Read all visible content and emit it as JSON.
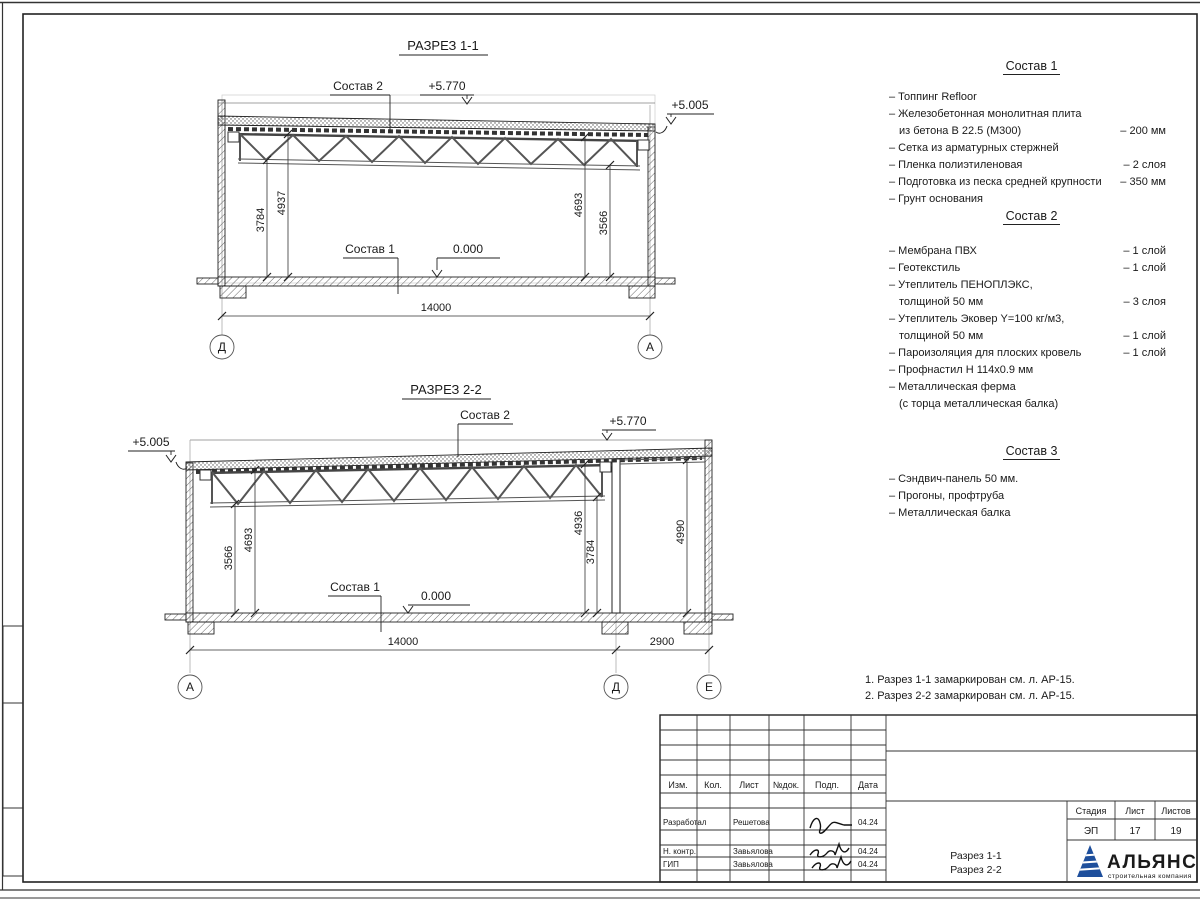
{
  "drawing": {
    "section1": {
      "title": "РАЗРЕЗ 1-1",
      "labels": {
        "sostav2": "Состав 2",
        "sostav1": "Состав 1",
        "elev_high": "+5.770",
        "elev_low": "+5.005",
        "elev_zero": "0.000"
      },
      "dims": {
        "d1": "3784",
        "d2": "4937",
        "d3": "4693",
        "d4": "3566",
        "span": "14000"
      },
      "axis_left": "Д",
      "axis_right": "А"
    },
    "section2": {
      "title": "РАЗРЕЗ 2-2",
      "labels": {
        "sostav2": "Состав 2",
        "sostav1": "Состав 1",
        "elev_high": "+5.770",
        "elev_low": "+5.005",
        "elev_zero": "0.000"
      },
      "dims": {
        "d1": "3566",
        "d2": "4693",
        "d3": "4936",
        "d4": "3784",
        "d5": "4990",
        "span": "14000",
        "span2": "2900"
      },
      "axis_left": "А",
      "axis_mid": "Д",
      "axis_right": "Е"
    }
  },
  "compositions": [
    {
      "title": "Состав 1",
      "items": [
        {
          "t": "– Топпинг Refloor"
        },
        {
          "t": "– Железобетонная  монолитная плита"
        },
        {
          "t": "из бетона В 22.5 (М300)",
          "v": "– 200 мм"
        },
        {
          "t": "– Сетка из арматурных стержней"
        },
        {
          "t": "– Пленка полиэтиленовая",
          "v": "– 2 слоя"
        },
        {
          "t": "– Подготовка из песка средней крупности",
          "v": "– 350 мм"
        },
        {
          "t": "– Грунт основания"
        }
      ]
    },
    {
      "title": "Состав 2",
      "items": [
        {
          "t": "– Мембрана ПВХ",
          "v": "– 1 слой"
        },
        {
          "t": "– Геотекстиль",
          "v": "– 1 слой"
        },
        {
          "t": "– Утеплитель ПЕНОПЛЭКС,"
        },
        {
          "t": "толщиной 50 мм",
          "v": "– 3 слоя"
        },
        {
          "t": "– Утеплитель Эковер Y=100 кг/м3,"
        },
        {
          "t": "толщиной 50 мм",
          "v": "– 1 слой"
        },
        {
          "t": "– Пароизоляция для плоских кровель",
          "v": "– 1 слой"
        },
        {
          "t": "– Профнастил Н 114х0.9 мм"
        },
        {
          "t": "– Металлическая ферма"
        },
        {
          "t": "(с торца металлическая балка)"
        }
      ]
    },
    {
      "title": "Состав 3",
      "items": [
        {
          "t": "– Сэндвич-панель 50 мм."
        },
        {
          "t": "– Прогоны, профтруба"
        },
        {
          "t": "– Металлическая балка"
        }
      ]
    }
  ],
  "notes": [
    "1. Разрез 1-1 замаркирован см. л. АР-15.",
    "2. Разрез 2-2 замаркирован см. л. АР-15."
  ],
  "titleblock": {
    "headers": [
      "Изм.",
      "Кол.",
      "Лист",
      "№док.",
      "Подп.",
      "Дата"
    ],
    "rows": [
      {
        "role": "Разработал",
        "name": "Решетова",
        "date": "04.24"
      },
      {
        "role": "Н. контр.",
        "name": "Завьялова",
        "date": "04.24"
      },
      {
        "role": "ГИП",
        "name": "Завьялова",
        "date": "04.24"
      }
    ],
    "doc_title_line1": "Разрез 1-1",
    "doc_title_line2": "Разрез 2-2",
    "stage_label": "Стадия",
    "sheet_label": "Лист",
    "sheets_label": "Листов",
    "stage": "ЭП",
    "sheet": "17",
    "sheets": "19",
    "logo_name": "АЛЬЯНС",
    "logo_subtitle": "строительная компания"
  },
  "colors": {
    "line": "#1a1a1a",
    "logo_dark": "#1b2d7a",
    "logo_blue": "#1e4f9c",
    "logo_light": "#4577b8"
  }
}
